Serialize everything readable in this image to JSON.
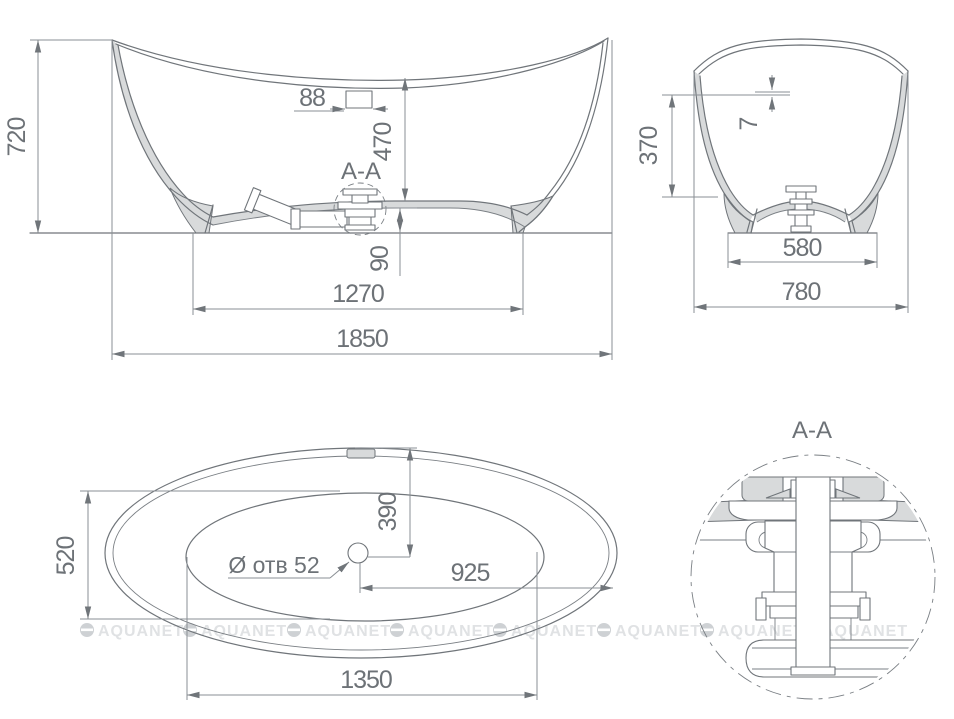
{
  "drawing": {
    "type": "bathtub dimensional drawing",
    "watermark": {
      "text": "AQUANET",
      "positions": [
        80,
        183,
        287,
        390,
        493,
        597,
        700,
        804
      ],
      "y": 630
    },
    "front_view": {
      "dims": {
        "overall_height": "720",
        "overflow_width": "88",
        "rim_to_bottom_depth": "470",
        "section_label": "A-A",
        "drain_outlet_height": "90",
        "base_length": "1270",
        "overall_length": "1850"
      }
    },
    "end_section_view": {
      "dims": {
        "rim_edge_thickness": "7",
        "interior_depth": "370",
        "base_width": "580",
        "overall_width": "780"
      }
    },
    "plan_view": {
      "dims": {
        "interior_width": "520",
        "drain_to_side": "390",
        "drain_hole_label": "Ø отв 52",
        "drain_to_end": "925",
        "interior_length": "1350"
      }
    },
    "detail_view": {
      "title": "A-A"
    }
  },
  "colors": {
    "line": "#70757a",
    "dimension_line": "#8a8f94",
    "text": "#6d7277",
    "shell_fill": "#d8dadb",
    "watermark_text": "#e0e2e4",
    "watermark_logo": "#ced1d4",
    "background": "#ffffff"
  }
}
